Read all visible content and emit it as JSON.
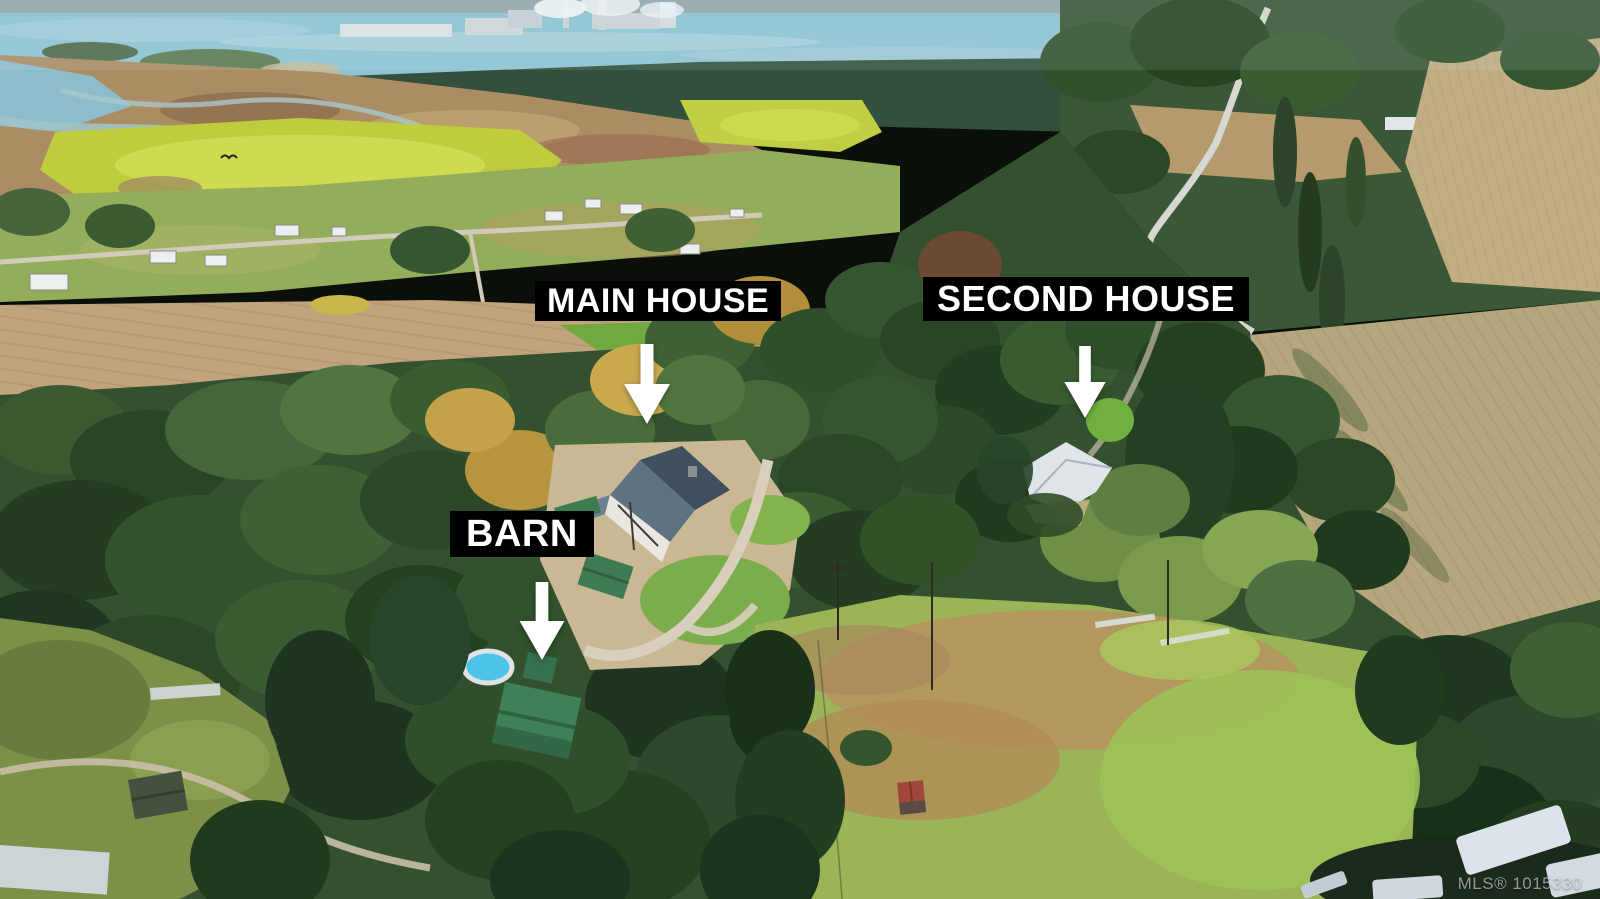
{
  "photo": {
    "scene": "Aerial drone view of a rural treed acreage with ocean, estuary marsh, farm fields and forest beyond"
  },
  "annotations": {
    "main_house": {
      "label": "MAIN HOUSE"
    },
    "second_house": {
      "label": "SECOND HOUSE"
    },
    "barn": {
      "label": "BARN"
    }
  },
  "watermark": {
    "text": "MLS® 1015330"
  },
  "colors": {
    "label_background": "#000000",
    "label_text": "#ffffff",
    "arrow": "#ffffff",
    "watermark_text": "#e8eef5"
  }
}
